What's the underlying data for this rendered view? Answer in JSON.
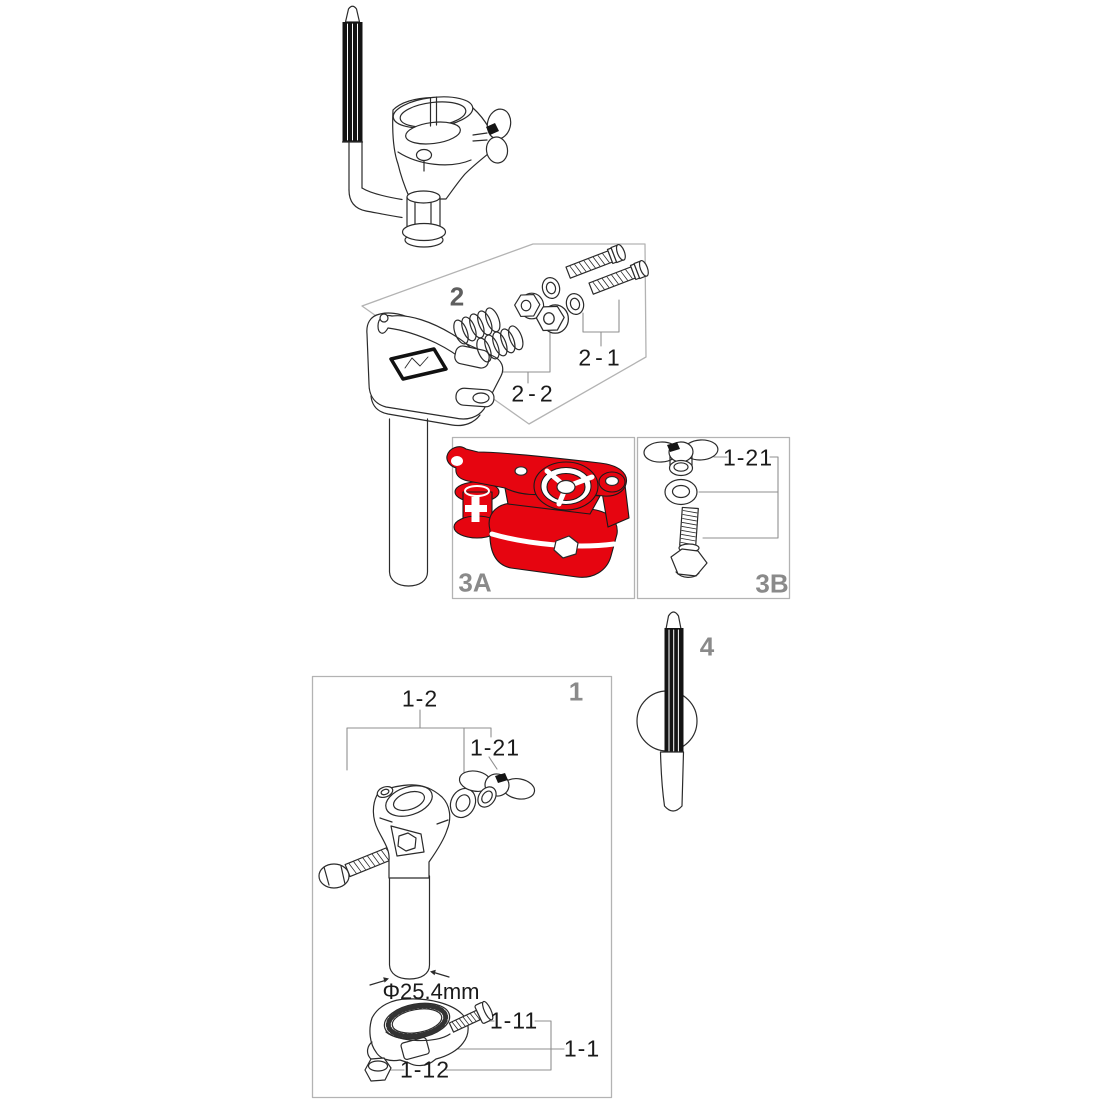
{
  "diagram": {
    "type": "exploded-parts-diagram",
    "highlight_color": "#e60510",
    "line_color": "#2b2b2b",
    "box_border_color": "#b3b3b3",
    "callout_line_color": "#8f8f8f",
    "section_label_color": "#8a8a8a",
    "section_labels": {
      "box1": "1",
      "box2": "2",
      "box3a": "3A",
      "box3b": "3B",
      "part4": "4"
    },
    "callouts": {
      "c2_1": "2-1",
      "c2_2": "2-2",
      "c3b_1_21": "1-21",
      "c1_2": "1-2",
      "c1_21": "1-21",
      "c1_11": "1-11",
      "c1_1": "1-1",
      "c1_12": "1-12",
      "dim_diameter": "Φ25.4mm"
    }
  }
}
